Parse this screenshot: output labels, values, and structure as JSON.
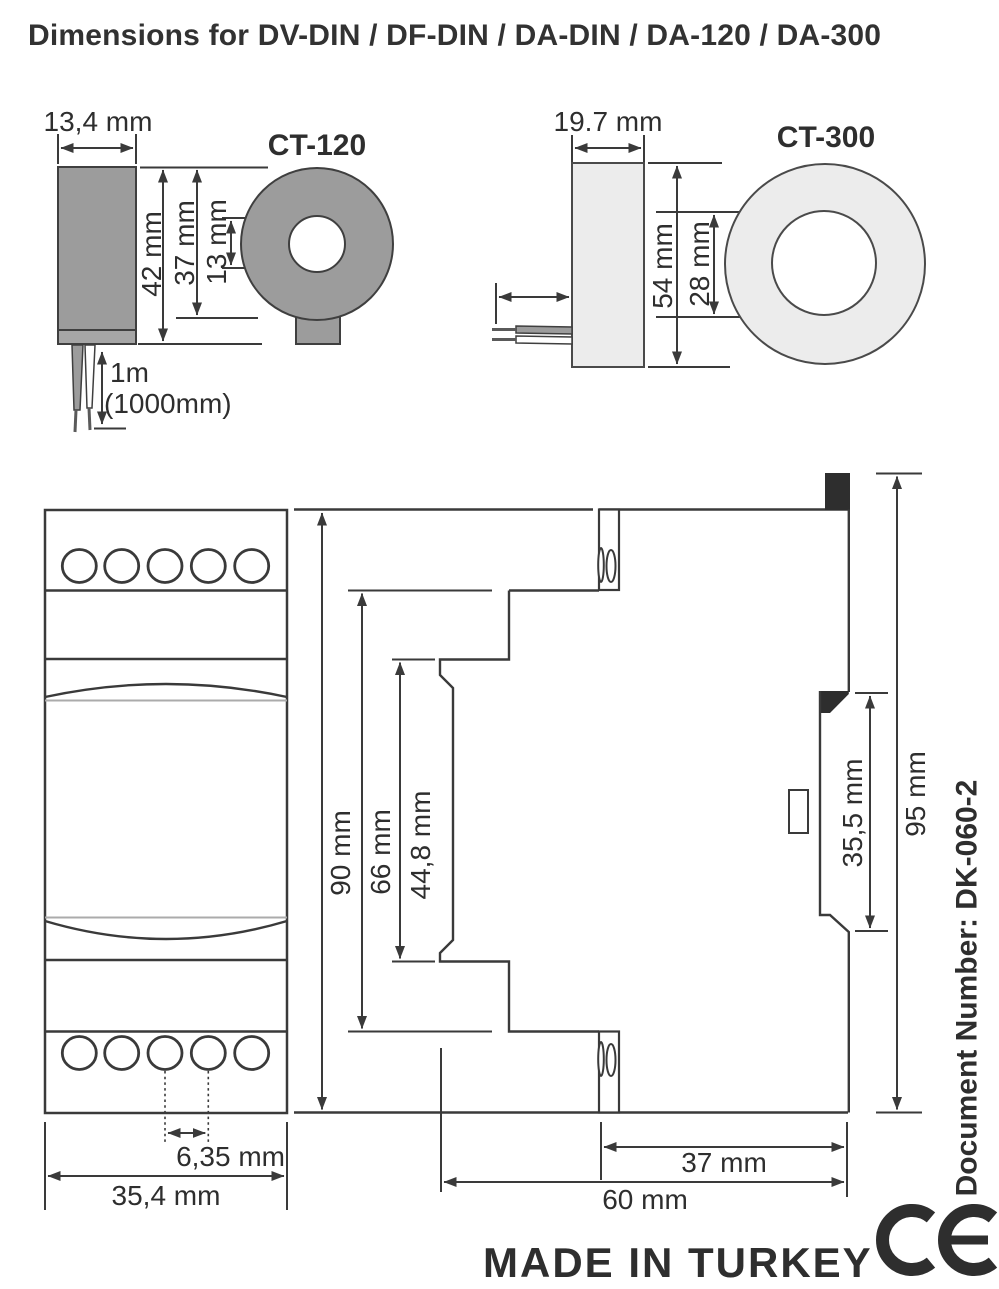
{
  "title": "Dimensions for DV-DIN / DF-DIN / DA-DIN / DA-120 / DA-300",
  "ct120": {
    "name": "CT-120",
    "width": "13,4 mm",
    "height": "42 mm",
    "body_height": "37 mm",
    "hole_diameter": "13 mm",
    "cable_length": "1m",
    "cable_length_alt": "(1000mm)"
  },
  "ct300": {
    "name": "CT-300",
    "width": "19.7 mm",
    "height": "54 mm",
    "hole_diameter": "28 mm"
  },
  "din_module": {
    "front_height": "90 mm",
    "front_width": "35,4 mm",
    "terminal_pitch": "6,35 mm",
    "mid_section_height": "66 mm",
    "front_panel_height": "44,8 mm",
    "rail_seat_height": "35,5 mm",
    "overall_height": "95 mm",
    "terminal_depth": "37 mm",
    "overall_depth": "60 mm"
  },
  "footer": {
    "document_number": "Document Number: DK-060-2",
    "made_in": "MADE IN TURKEY",
    "ce_mark": "CE"
  },
  "colors": {
    "line": "#3a3a3a",
    "ct120_fill": "#9c9c9c",
    "ct300_fill": "#ececec",
    "accent_gray": "#ababab",
    "black_fill": "#2e2e2e"
  }
}
